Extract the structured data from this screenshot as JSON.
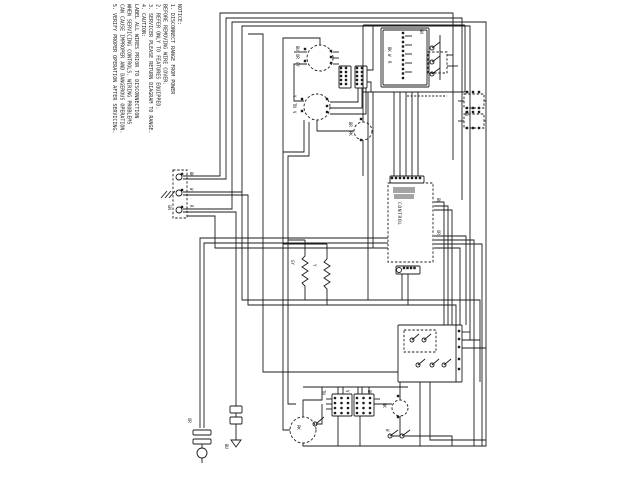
{
  "notice": {
    "lines": [
      "NOTICE:",
      "1. DISCONNECT RANGE FROM POWER",
      "   BEFORE REMOVING WIRE COVER.",
      "2. REFER ONLY TO FEATURES EQUIPPED.",
      "3. SERVICER PLEASE RETURN DIAGRAM TO RANGE.",
      "4. CAUTION:",
      "   LABEL ALL WIRES PRIOR TO DISCONNECTION",
      "   WHEN SERVICING CONTROLS. WIRING PROBLEMS",
      "   CAN CAUSE IMPROPER AND DANGEROUS OPERATION.",
      "5. VERIFY PROPER OPERATION AFTER SERVICING."
    ]
  },
  "labels": {
    "control_board_vertical": "CONTROL",
    "wire_colors": [
      "BK",
      "W",
      "R",
      "GN",
      "BU",
      "OR",
      "GY",
      "Y",
      "TN",
      "V",
      "BR",
      "PK"
    ]
  },
  "colors": {
    "ink": "#1b1b1b",
    "paper": "#ffffff"
  },
  "components": [
    "power-terminal-block",
    "surface-burner-switch-top",
    "surface-burner-switch-bottom",
    "oven-lamp",
    "clock-control-board",
    "oven-control-board",
    "relay-box-upper",
    "relay-box-lower",
    "bake-element-coil",
    "broil-element-coil",
    "lower-relay-board",
    "oven-motor",
    "convection-motor",
    "junction-terminal-blocks",
    "power-cord-plug",
    "ground-symbol"
  ]
}
